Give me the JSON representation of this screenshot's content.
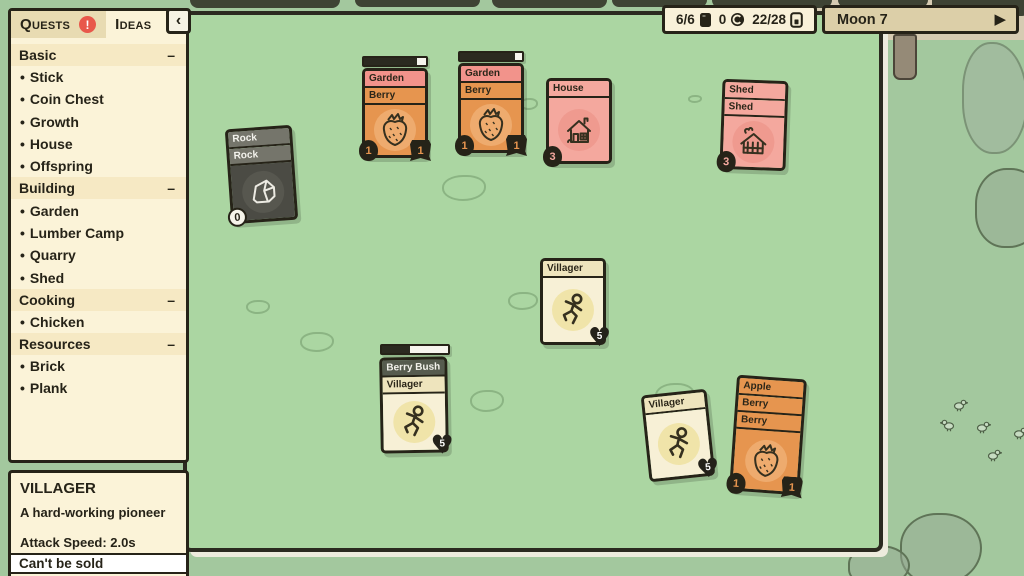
{
  "glyphs": {
    "heart": "♥"
  },
  "quest_panel": {
    "tabs": [
      {
        "label": "Quests",
        "badge": "!"
      },
      {
        "label": "Ideas",
        "badge": ""
      }
    ],
    "collapse_button": "‹",
    "collapse_glyph": "–",
    "bullet_glyph": "•",
    "sections": [
      {
        "title": "Basic",
        "items": [
          "Stick",
          "Coin Chest",
          "Growth",
          "House",
          "Offspring"
        ]
      },
      {
        "title": "Building",
        "items": [
          "Garden",
          "Lumber Camp",
          "Quarry",
          "Shed"
        ]
      },
      {
        "title": "Cooking",
        "items": [
          "Chicken"
        ]
      },
      {
        "title": "Resources",
        "items": [
          "Brick",
          "Plank"
        ]
      }
    ]
  },
  "info_panel": {
    "title": "VILLAGER",
    "description": "A hard-working pioneer",
    "stats": [
      "Attack Speed: 2.0s",
      "Hit Chance: 60%"
    ],
    "footer": "Can't be sold"
  },
  "top_bar": {
    "food_count": "6/6",
    "coin_count": "0",
    "card_count": "22/28",
    "moon_label": "Moon 7",
    "play_glyph": "▶"
  },
  "board": {
    "cards": [
      {
        "name": "rock-stack",
        "titles": [
          "Rock",
          "Rock"
        ],
        "icon": "rock-icon",
        "badges": [
          {
            "value": "0"
          }
        ]
      },
      {
        "name": "garden-berry-stack-1",
        "titles": [
          "Garden",
          "Berry"
        ],
        "icon": "strawberry-icon",
        "progress": "86%",
        "badges": [
          {
            "value": "1"
          },
          {
            "value": "1"
          }
        ]
      },
      {
        "name": "garden-berry-stack-2",
        "titles": [
          "Garden",
          "Berry"
        ],
        "icon": "strawberry-icon",
        "progress": "88%",
        "badges": [
          {
            "value": "1"
          },
          {
            "value": "1"
          }
        ]
      },
      {
        "name": "house",
        "titles": [
          "House"
        ],
        "icon": "house-icon",
        "badges": [
          {
            "value": "3"
          }
        ]
      },
      {
        "name": "shed-stack",
        "titles": [
          "Shed",
          "Shed"
        ],
        "icon": "shed-icon",
        "badges": [
          {
            "value": "3"
          }
        ]
      },
      {
        "name": "villager-1",
        "titles": [
          "Villager"
        ],
        "icon": "villager-icon",
        "badges": [
          {
            "value": "5"
          }
        ]
      },
      {
        "name": "berrybush-villager-stack",
        "titles": [
          "Berry Bush",
          "Villager"
        ],
        "icon": "villager-icon",
        "progress": "42%",
        "badges": [
          {
            "value": "5"
          }
        ]
      },
      {
        "name": "villager-2",
        "titles": [
          "Villager"
        ],
        "icon": "villager-icon",
        "badges": [
          {
            "value": "5"
          }
        ]
      },
      {
        "name": "apple-berry-stack",
        "titles": [
          "Apple",
          "Berry",
          "Berry"
        ],
        "icon": "strawberry-icon",
        "badges": [
          {
            "value": "1"
          },
          {
            "value": "1"
          }
        ]
      }
    ]
  },
  "colors": {
    "board_green": "#abd6a2",
    "world_green": "#a3c89e",
    "panel_cream": "#fbf3d8",
    "ink": "#262318",
    "card_orange": "#e6954f",
    "card_pink": "#f4a89e",
    "title_pink": "#f2938b",
    "card_cream": "#f7f0d6",
    "card_rock": "#4b4b44",
    "alert_red": "#e8584b",
    "moon_tan": "#dccfa8"
  }
}
